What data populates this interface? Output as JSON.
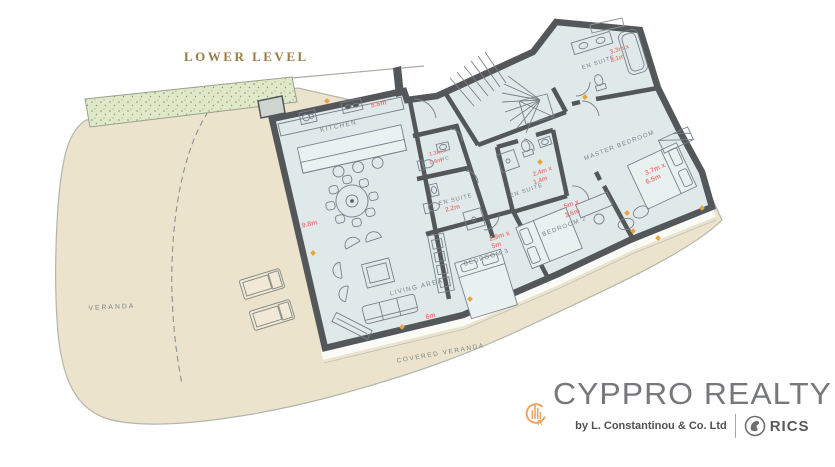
{
  "title": "LOWER LEVEL",
  "outdoor": {
    "veranda_label": "VERANDA",
    "covered_veranda_label": "COVERED VERANDA"
  },
  "rooms": {
    "kitchen": {
      "label": "KITCHEN",
      "dim_top": "5.6m",
      "dim_side": "9.8m"
    },
    "living": {
      "label": "LIVING AREA",
      "dim_bottom": "6m"
    },
    "wc": {
      "label": "WC",
      "dim1": "1.3m x",
      "dim2": "1.9m"
    },
    "en_suite_1": {
      "label": "EN SUITE",
      "dim1": "2.2m"
    },
    "bedroom_3": {
      "label": "BEDROOM 3",
      "dim1": "2.9m x",
      "dim2": "5m"
    },
    "en_suite_2": {
      "label": "EN SUITE",
      "dim1": "2.4m x",
      "dim2": "1.4m"
    },
    "bedroom_2": {
      "label": "BEDROOM 2",
      "dim1": "5m x",
      "dim2": "3.6m"
    },
    "master": {
      "label": "MASTER BEDROOM",
      "dim1": "3.7m x",
      "dim2": "6.5m"
    },
    "en_suite_3": {
      "label": "EN SUITE",
      "dim1": "3.3m x",
      "dim2": "2.1m"
    }
  },
  "branding": {
    "name": "CYPPRO REALTY",
    "tagline": "by L. Constantinou & Co. Ltd",
    "accreditation": "RICS",
    "monogram_letter": "R"
  },
  "colors": {
    "wall": "#54575a",
    "room_fill": "#dfe9ea",
    "veranda_fill": "#ece3cd",
    "planter_fill": "#dfe8c8",
    "dimension_text": "#ef7e7e",
    "room_label_text": "#7d8487",
    "title_text": "#9a7b45",
    "door_marker": "#e8a33d",
    "logo_orange": "#f0a560",
    "logo_gray": "#77787b"
  }
}
